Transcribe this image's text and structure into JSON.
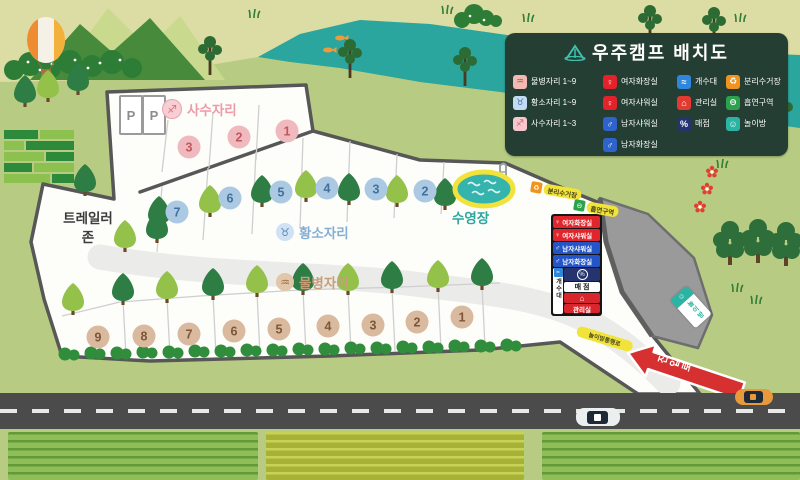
{
  "legend": {
    "title": "우주캠프 배치도",
    "columns": [
      {
        "items": [
          {
            "label": "물병자리 1~9",
            "icon": "aquarius-icon"
          },
          {
            "label": "황소자리 1~9",
            "icon": "taurus-icon"
          },
          {
            "label": "사수자리 1~3",
            "icon": "sagittarius-icon"
          }
        ]
      },
      {
        "items": [
          {
            "label": "여자화장실",
            "icon": "female-toilet-icon"
          },
          {
            "label": "여자샤워실",
            "icon": "female-shower-icon"
          },
          {
            "label": "남자샤워실",
            "icon": "male-shower-icon"
          },
          {
            "label": "남자화장실",
            "icon": "male-toilet-icon"
          }
        ]
      },
      {
        "items": [
          {
            "label": "개수대",
            "icon": "sink-icon"
          },
          {
            "label": "관리실",
            "icon": "office-icon"
          },
          {
            "label": "매점",
            "icon": "store-icon"
          }
        ]
      },
      {
        "items": [
          {
            "label": "분리수거장",
            "icon": "recycle-icon"
          },
          {
            "label": "흡연구역",
            "icon": "smoking-icon"
          },
          {
            "label": "놀이방",
            "icon": "playroom-icon"
          }
        ]
      }
    ]
  },
  "zones": {
    "sagittarius": {
      "label": "사수자리",
      "sites": [
        "3",
        "2",
        "1"
      ]
    },
    "taurus": {
      "label": "황소자리",
      "sites": [
        "7",
        "6",
        "5",
        "4",
        "3",
        "2"
      ]
    },
    "aquarius": {
      "label": "물병자리",
      "sites": [
        "9",
        "8",
        "7",
        "6",
        "5",
        "4",
        "3",
        "2",
        "1"
      ]
    }
  },
  "pool": {
    "label": "수영장"
  },
  "trailer_zone": {
    "label": "트레일러\n존"
  },
  "parking": {
    "label": "P"
  },
  "building": {
    "rows": [
      "여자화장실",
      "여자샤워실",
      "남자샤워실",
      "남자화장실"
    ],
    "sink": "개수대",
    "store": "매 점",
    "office": "관리실"
  },
  "signs": {
    "recycling": "분리수거장",
    "smoking": "흡연구역",
    "playroom": "놀이방",
    "playroom_path": "놀이방통행로",
    "entrance_arrow": "진입로"
  },
  "glyphs": {
    "aquarius": "♒",
    "taurus": "♉",
    "sagittarius": "♐",
    "female": "♀",
    "male": "♂",
    "sink": "≈",
    "office": "⌂",
    "store": "%",
    "recycle": "♻",
    "smoking": "⊖",
    "playroom": "☺"
  },
  "colors": {
    "background": "#b7cc82",
    "top_band": "#dcdda4",
    "river": "#2aa69e",
    "legend_bg": "#243e33",
    "camp_fill": "#fdfdfa",
    "camp_border": "#575757",
    "road": "#4b4b4b",
    "pool_water": "#35b3ad",
    "pool_ring": "#f2e33b",
    "arrow_red": "#d63031",
    "site_pink": "#f0b9bd",
    "site_blue": "#abc9e3",
    "site_tan": "#d9ba9e",
    "cliff_gray": "#9a9a9a"
  }
}
